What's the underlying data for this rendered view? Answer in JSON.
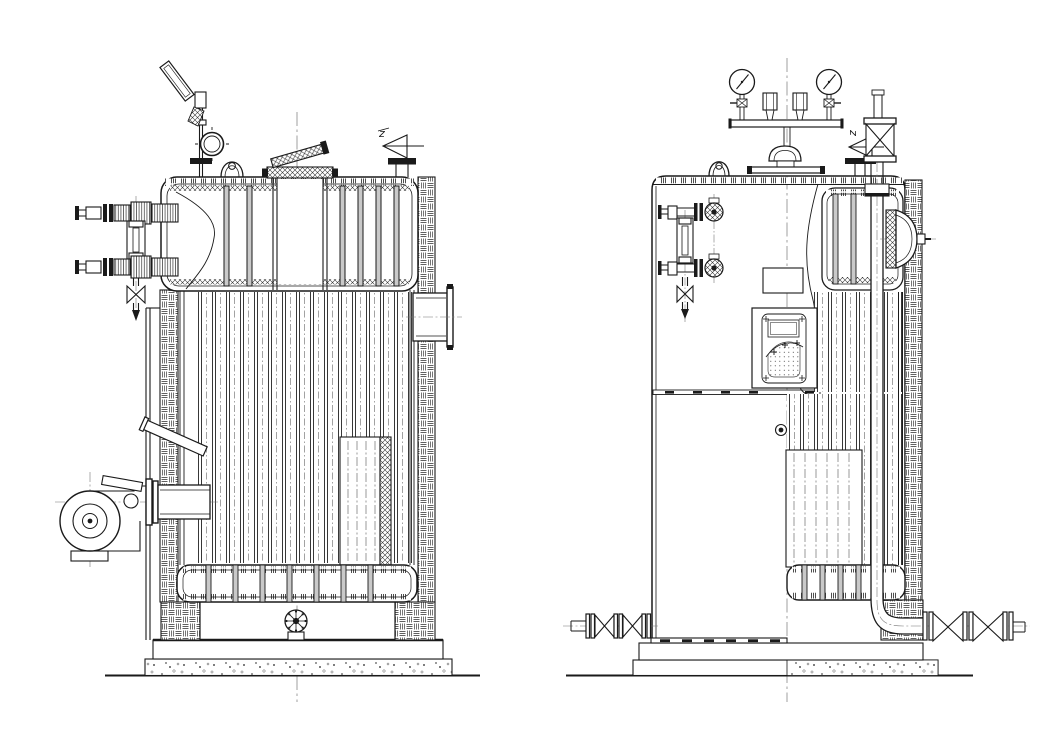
{
  "drawing": {
    "background_color": "#ffffff",
    "line_color": "#1a1a1a",
    "views": {
      "left_view": {
        "name": "boiler-side-elevation"
      },
      "right_view": {
        "name": "boiler-front-elevation"
      }
    },
    "labels": {
      "left_safety_valve": "z",
      "right_safety_valve": "z"
    },
    "components": [
      "angled-thermometer",
      "siphon-loop",
      "lifting-lug",
      "chimney-with-rain-cap",
      "safety-valve",
      "water-level-gauge",
      "gauge-drain-valve",
      "burner-blower",
      "flue-gas-outlet",
      "insulated-brick-wall",
      "tube-bank",
      "upper-drum",
      "lower-drum",
      "access-panel",
      "handwheel-fitting",
      "base-skirt",
      "concrete-foundation",
      "pressure-gauge",
      "gauge-cock",
      "gauge-manifold",
      "steam-dome",
      "globe-valve",
      "steam-downcomer-pipe",
      "junction-box",
      "inspection-panel",
      "manhole-cover",
      "burner-mounting-flange",
      "blowdown-gate-valves",
      "feed-gate-valves",
      "pipe-elbow"
    ]
  }
}
